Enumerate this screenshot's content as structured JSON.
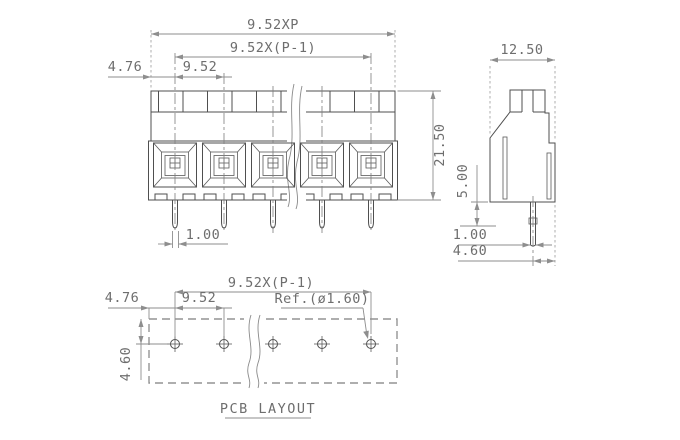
{
  "drawing": {
    "front_view": {
      "dim_total_pitch": "9.52XP",
      "dim_span": "9.52X(P-1)",
      "dim_edge_offset": "4.76",
      "dim_pitch": "9.52",
      "dim_height": "21.50",
      "dim_pin_width": "1.00"
    },
    "side_view": {
      "dim_width": "12.50",
      "dim_pin_length": "5.00",
      "dim_pin_width": "1.00",
      "dim_pin_offset": "4.60"
    },
    "pcb_layout": {
      "dim_span": "9.52X(P-1)",
      "dim_edge_offset": "4.76",
      "dim_pitch": "9.52",
      "dim_hole_ref": "Ref.(ø1.60)",
      "dim_row_offset": "4.60",
      "title": "PCB LAYOUT"
    }
  },
  "colors": {
    "outline": "#4f4f4f",
    "dimension": "#8e8e8e",
    "text": "#6e6e6e",
    "background": "#ffffff"
  }
}
